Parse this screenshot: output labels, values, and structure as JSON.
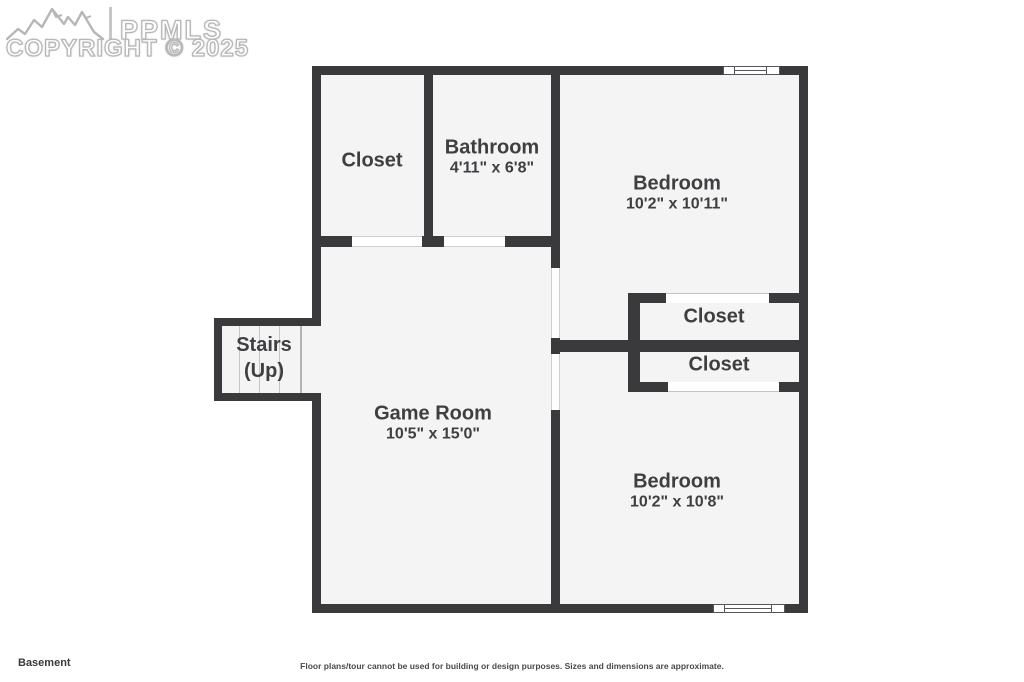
{
  "watermark": {
    "logo_text": "PPMLS",
    "copyright": "COPYRIGHT © 2025"
  },
  "rooms": {
    "closet_tl": {
      "name": "Closet"
    },
    "bathroom": {
      "name": "Bathroom",
      "dims": "4'11\" x 6'8\""
    },
    "bedroom_1": {
      "name": "Bedroom",
      "dims": "10'2\" x 10'11\""
    },
    "closet_1": {
      "name": "Closet"
    },
    "closet_2": {
      "name": "Closet"
    },
    "stairs": {
      "name": "Stairs",
      "sub": "(Up)"
    },
    "game_room": {
      "name": "Game Room",
      "dims": "10'5\" x 15'0\""
    },
    "bedroom_2": {
      "name": "Bedroom",
      "dims": "10'2\" x 10'8\""
    }
  },
  "footer": {
    "floor_label": "Basement",
    "disclaimer": "Floor plans/tour cannot be used for building or design purposes. Sizes and dimensions are approximate."
  },
  "colors": {
    "wall": "#3a3a3c",
    "room_fill": "#f4f4f5",
    "label_text": "#3f3f42",
    "watermark_outline": "#b7b7b7"
  }
}
